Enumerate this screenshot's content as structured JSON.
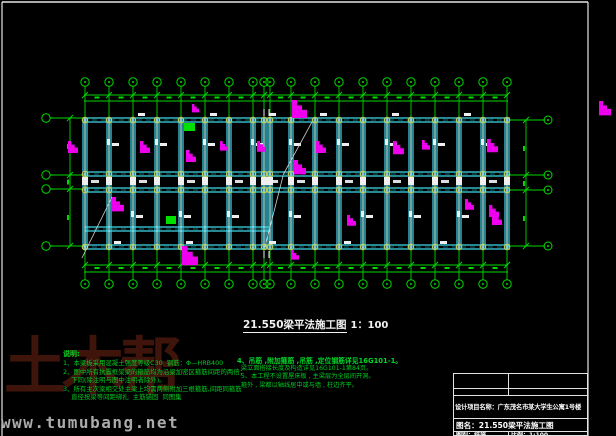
{
  "colors": {
    "grid_green": "#00d800",
    "beam_cyan": "#3fd9e8",
    "beam_core": "#aef4fa",
    "axis_dash": "#0d6b75",
    "column_circle": "#c9c945",
    "flag_magenta": "#ee00ee",
    "white": "#efefef",
    "diagonal_gray": "#cfcfcf",
    "notes_green": "#00cc22",
    "logo_red": "#3f140b",
    "watermark_gray": "#ababab"
  },
  "main_title": {
    "text": "21.550梁平法施工图",
    "scale": "1：100"
  },
  "notes": {
    "heading": "说明:",
    "left": [
      "1、本梁板采用混凝土强度等级C30  钢筋：Φ—HRB400",
      "2、图中所有抗震框架梁的箍筋均为沿梁加密区箍筋间距的两倍；",
      "    下同(除注明与图中注明者除外)。",
      "3、所有主次梁相交处主梁上均需两侧附加三根箍筋,间距同箍筋",
      "    直径按梁等间距绑扎  主筋锚固  同图集"
    ],
    "right": [
      "4、吊筋 ,附加箍筋 ,吊筋 ,定位钢筋详见16G101-1。",
      "  梁立面搭接长度及构造详见16G101-1第84页。",
      "  5、本工程不设置屋床板 , 主梁层为全层间开洞。",
      "  箍外 , 梁都以轴线居中或与墙 , 柱边齐平。"
    ]
  },
  "title_block": {
    "project": "设计项目名称：广东茂名市某大学生公寓1号楼",
    "drawing_name": "图名：21.550梁平法施工图",
    "cell_type": "图别：结施",
    "cell_scale": "比例：1:100"
  },
  "watermark": "www.tumubang.net",
  "logo": "土木帮",
  "plan": {
    "columns": [
      85,
      109,
      133,
      157,
      181,
      205,
      229,
      253,
      264,
      270,
      291,
      315,
      339,
      363,
      387,
      411,
      435,
      459,
      483,
      507
    ],
    "rows": {
      "top": 120,
      "corridor1": 174,
      "corridor2": 190,
      "bottom": 247,
      "left_extra": 229
    },
    "left_extra_span": [
      85,
      270
    ],
    "x_start": 84,
    "x_end": 508,
    "top": {
      "bubble_y": 82,
      "stem_y1": 86,
      "stem_y2": 118,
      "dim_y1": 95,
      "dim_y2": 101
    },
    "bottom": {
      "bubble_y": 284,
      "stem_y1": 249,
      "stem_y2": 280,
      "dim_y1": 265,
      "dim_y2": 272
    },
    "left": {
      "bubble_x": 46,
      "dim_x": 70,
      "leader_x2": 85,
      "ys": [
        118,
        175,
        189,
        246
      ]
    },
    "right": {
      "bubble_x": 548,
      "dim_x": 526,
      "leader_x1": 508,
      "leader_x2": 545,
      "ys": [
        120,
        175,
        190,
        246
      ]
    },
    "frame": {
      "top_y": 2,
      "left_x": 2,
      "right_x": 588
    },
    "flags": [
      [
        68,
        141,
        1
      ],
      [
        140,
        141,
        1
      ],
      [
        186,
        150,
        1
      ],
      [
        192,
        104,
        0.7
      ],
      [
        220,
        141,
        0.8
      ],
      [
        257,
        141,
        0.9
      ],
      [
        292,
        100,
        1.5
      ],
      [
        294,
        160,
        1.2
      ],
      [
        316,
        141,
        1
      ],
      [
        347,
        215,
        0.9
      ],
      [
        393,
        141,
        1.1
      ],
      [
        422,
        140,
        0.8
      ],
      [
        465,
        199,
        0.9
      ],
      [
        487,
        139,
        1.1
      ],
      [
        489,
        205,
        1
      ],
      [
        112,
        197,
        1.2
      ],
      [
        182,
        246,
        1.6
      ],
      [
        291,
        250,
        0.8
      ],
      [
        492,
        213,
        1
      ],
      [
        599,
        101,
        1.2
      ]
    ],
    "green_rects": [
      [
        184,
        123,
        11,
        8
      ],
      [
        166,
        216,
        10,
        8
      ]
    ],
    "diagonals": [
      [
        82,
        258,
        112,
        197
      ],
      [
        265,
        247,
        283,
        176
      ],
      [
        283,
        175,
        312,
        122
      ]
    ],
    "joint_ticks_x": [
      264,
      269
    ],
    "marks": {
      "top_beam": [
        2,
        5,
        8,
        11,
        14,
        17
      ],
      "band1": [
        1,
        3,
        5,
        7,
        10,
        12,
        14,
        16,
        18
      ],
      "band2": [
        2,
        4,
        6,
        10,
        13,
        15,
        17
      ],
      "bottom_beam": [
        1,
        4,
        8,
        12,
        16
      ]
    }
  }
}
